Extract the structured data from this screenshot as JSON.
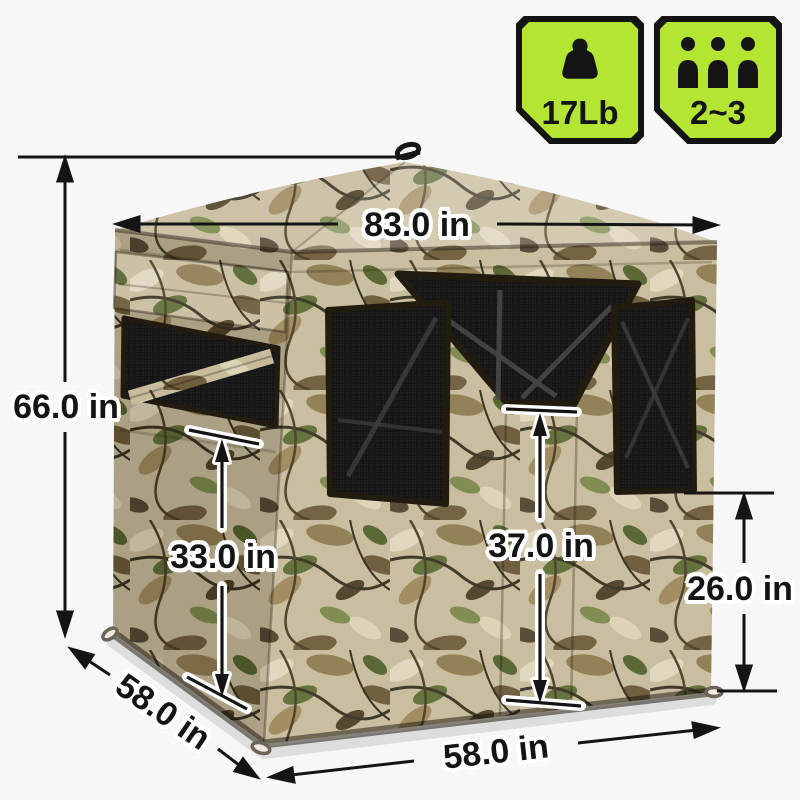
{
  "page": {
    "background": "#f7f7f7"
  },
  "badges": {
    "weight": {
      "label": "17Lb",
      "icon": "weight-icon"
    },
    "capacity": {
      "label": "2~3",
      "icon": "people-icon"
    },
    "style": {
      "background": "#b5e533",
      "border": "#141414",
      "text": "#141414"
    }
  },
  "dimensions": {
    "top_width": "83.0 in",
    "total_height": "66.0 in",
    "left_window_height": "33.0 in",
    "center_window_height": "37.0 in",
    "right_window_height": "26.0 in",
    "side_depth": "58.0 in",
    "front_width": "58.0 in"
  },
  "dimension_style": {
    "line_color": "#141414",
    "text_color": "#141414",
    "halo_color": "#ffffff"
  },
  "illustration": {
    "subject": "camo-pop-up-hunting-blind",
    "mesh_color": "#181818"
  }
}
